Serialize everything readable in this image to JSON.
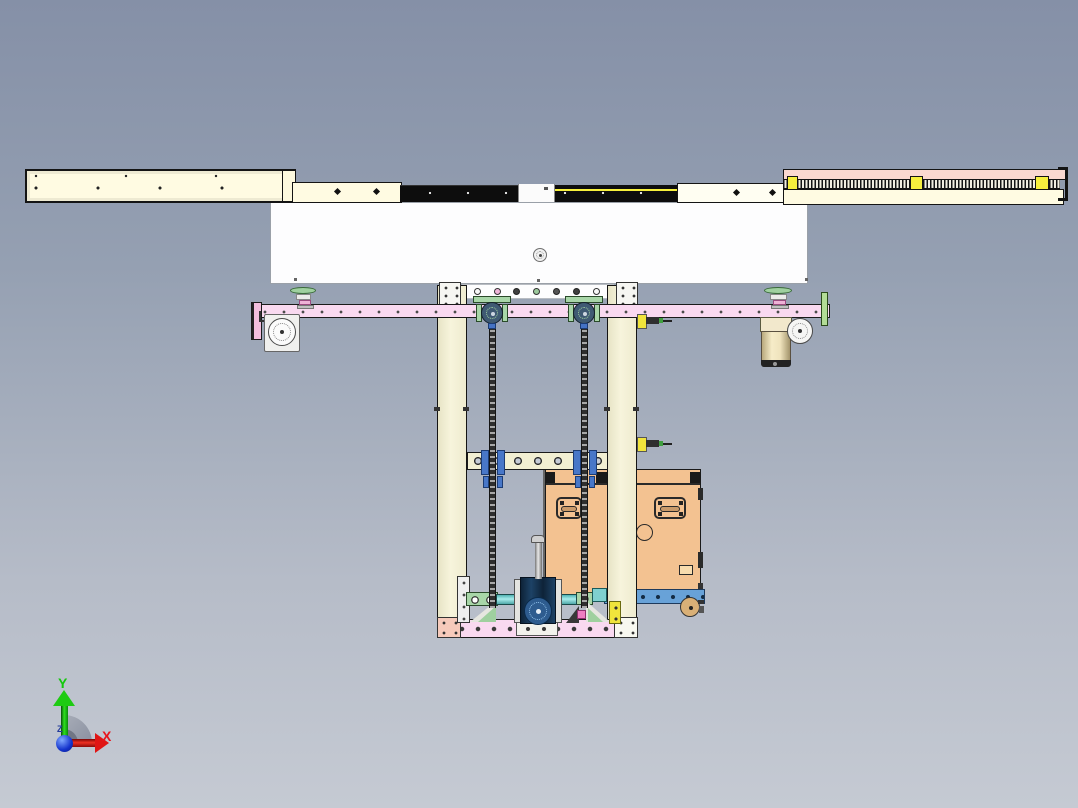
{
  "viewport": {
    "name": "CAD assembly front view"
  },
  "triad": {
    "y_label": "Y",
    "x_label": "X",
    "z_label": "Z"
  },
  "palette": {
    "background_top": "#8590a7",
    "background_bottom": "#c5cad3",
    "rail_cream": "#fffbe2",
    "frame_cream": "#f2efd2",
    "carriage_white": "#fdfdfe",
    "beam_pink": "#f9d9f0",
    "rail_top_pink": "#fad8d0",
    "slide_yellow": "#f6ef3e",
    "box_orange": "#f3c291",
    "rail_blue": "#68a2d8",
    "plate_green": "#a8d6a8",
    "cylinder_cyan": "#7fd4d4",
    "gearbox_blue": "#16324f",
    "chain_dark": "#2e2e2e",
    "axis_x_red": "#e8141c",
    "axis_y_green": "#14c80c",
    "axis_z_blue": "#2239c9"
  }
}
